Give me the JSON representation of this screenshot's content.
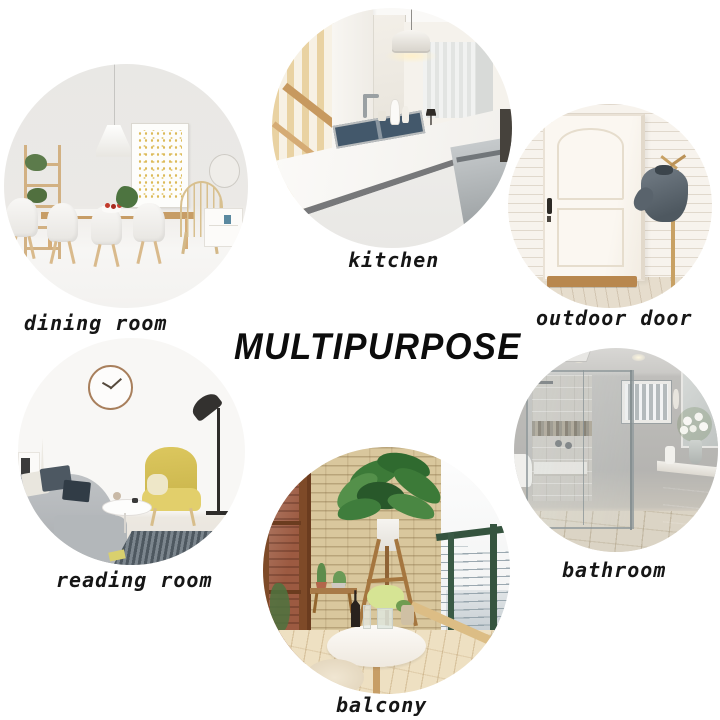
{
  "title": "MULTIPURPOSE",
  "colors": {
    "background": "#ffffff",
    "text": "#161616",
    "title_text": "#0c0c0c"
  },
  "sections": [
    {
      "id": "dining-room",
      "label": "dining room"
    },
    {
      "id": "kitchen",
      "label": "kitchen"
    },
    {
      "id": "outdoor-door",
      "label": "outdoor door"
    },
    {
      "id": "reading-room",
      "label": "reading room"
    },
    {
      "id": "balcony",
      "label": "balcony"
    },
    {
      "id": "bathroom",
      "label": "bathroom"
    }
  ]
}
